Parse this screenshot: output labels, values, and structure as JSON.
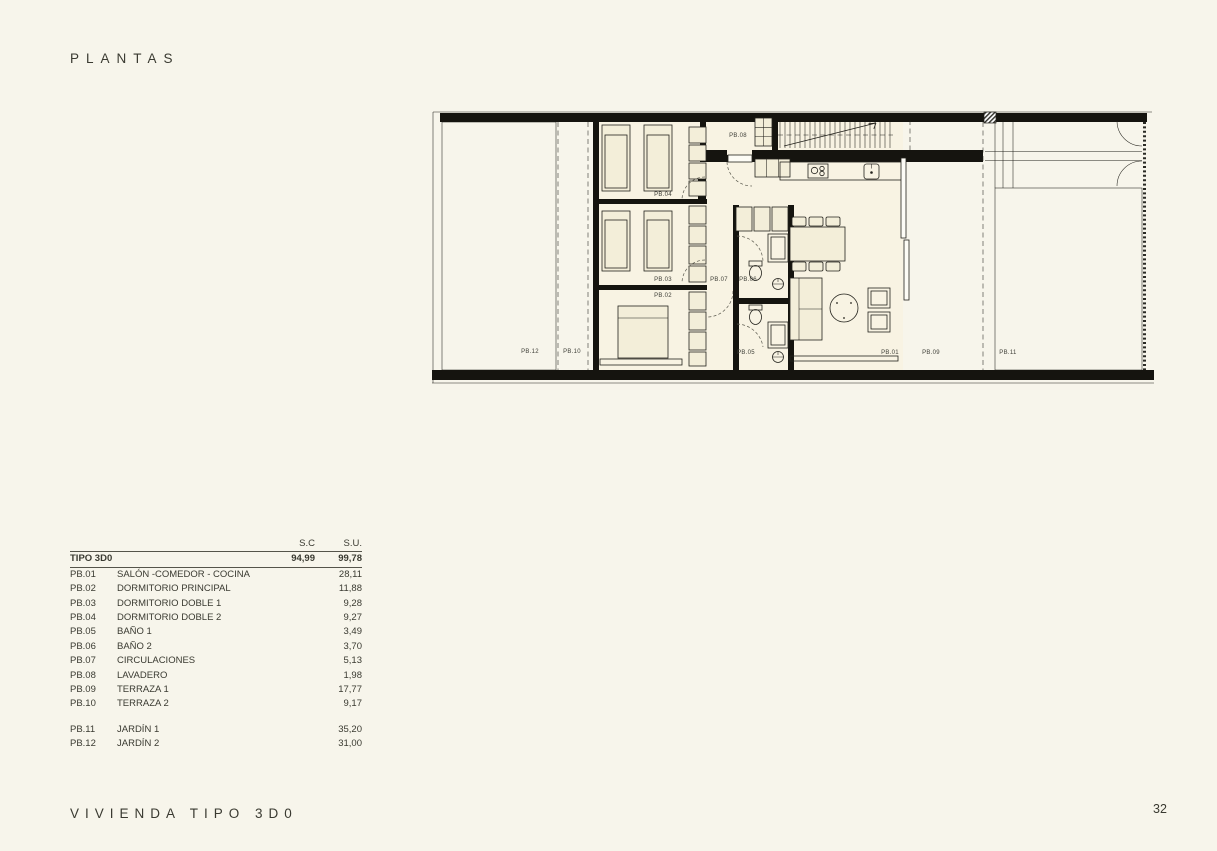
{
  "page": {
    "title": "PLANTAS",
    "footer": "VIVIENDA TIPO 3D0",
    "page_number": "32"
  },
  "table": {
    "columns": {
      "sc": "S.C",
      "su": "S.U."
    },
    "summary": {
      "label": "TIPO 3D0",
      "sc": "94,99",
      "su": "99,78"
    },
    "rows": [
      {
        "code": "PB.01",
        "name": "SALÓN -COMEDOR - COCINA",
        "su": "28,11"
      },
      {
        "code": "PB.02",
        "name": "DORMITORIO PRINCIPAL",
        "su": "11,88"
      },
      {
        "code": "PB.03",
        "name": "DORMITORIO DOBLE 1",
        "su": "9,28"
      },
      {
        "code": "PB.04",
        "name": "DORMITORIO DOBLE 2",
        "su": "9,27"
      },
      {
        "code": "PB.05",
        "name": "BAÑO 1",
        "su": "3,49"
      },
      {
        "code": "PB.06",
        "name": "BAÑO 2",
        "su": "3,70"
      },
      {
        "code": "PB.07",
        "name": "CIRCULACIONES",
        "su": "5,13"
      },
      {
        "code": "PB.08",
        "name": "LAVADERO",
        "su": "1,98"
      },
      {
        "code": "PB.09",
        "name": "TERRAZA 1",
        "su": "17,77"
      },
      {
        "code": "PB.10",
        "name": "TERRAZA 2",
        "su": "9,17"
      }
    ],
    "rows_outdoor": [
      {
        "code": "PB.11",
        "name": "JARDÍN 1",
        "su": "35,20"
      },
      {
        "code": "PB.12",
        "name": "JARDÍN 2",
        "su": "31,00"
      }
    ]
  },
  "plan": {
    "labels": {
      "pb01": "PB.01",
      "pb02": "PB.02",
      "pb03": "PB.03",
      "pb04": "PB.04",
      "pb05": "PB.05",
      "pb06": "PB.06",
      "pb07": "PB.07",
      "pb08": "PB.08",
      "pb09": "PB.09",
      "pb10": "PB.10",
      "pb11": "PB.11",
      "pb12": "PB.12"
    }
  },
  "colors": {
    "paper": "#f7f5eb",
    "ink": "#3a3a31",
    "wall": "#15140f",
    "line": "#23221c",
    "room": "#f8f3e3",
    "furniture": "#f3eed9",
    "rule": "#55544a",
    "garden": "#fdfcf5"
  }
}
